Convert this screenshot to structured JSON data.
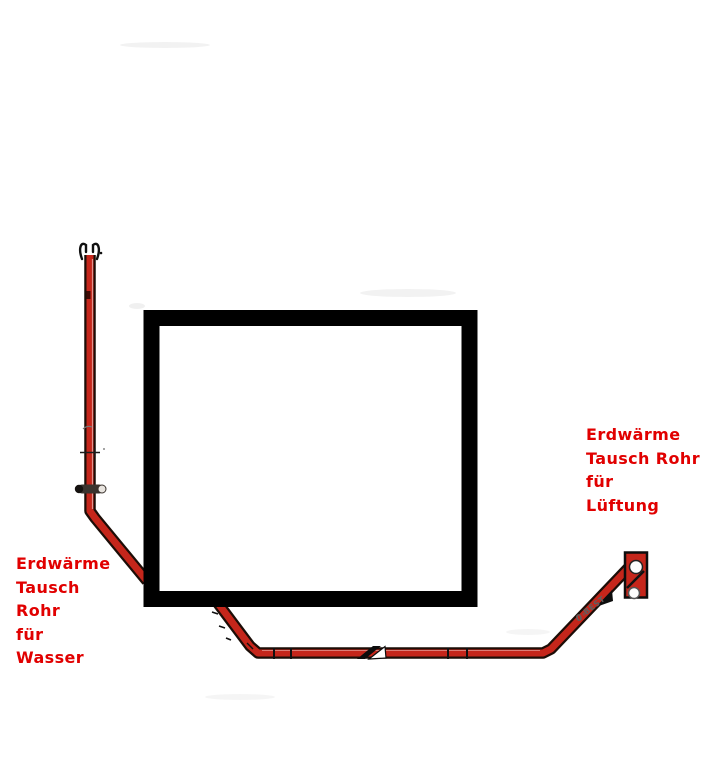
{
  "canvas": {
    "width": 707,
    "height": 771
  },
  "colors": {
    "background": "#ffffff",
    "pipe_red": "#c5261b",
    "pipe_outline": "#1c0d07",
    "building_black": "#000000",
    "label_red": "#e10000",
    "note_gray": "#5f5f5f"
  },
  "labels": {
    "water": {
      "lines": [
        "Erdwärme",
        "Tausch",
        "Rohr",
        "für",
        "Wasser"
      ]
    },
    "air": {
      "lines": [
        "Erdwärme",
        "Tausch Rohr",
        "für",
        "Lüftung"
      ]
    }
  },
  "annotations": {
    "pipe_note_top": "BEST",
    "pipe_note_bottom": "0°"
  }
}
